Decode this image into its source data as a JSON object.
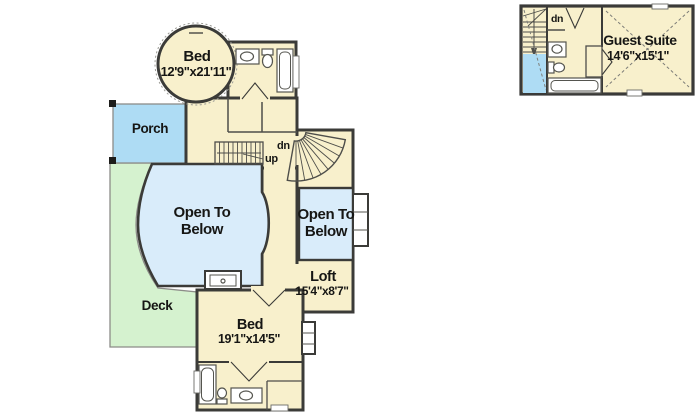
{
  "canvas": {
    "width": 700,
    "height": 412,
    "background": "#ffffff"
  },
  "colors": {
    "floor": "#f8f0cc",
    "wall": "#3b3b38",
    "open_below": "#d9ecfa",
    "porch": "#aedcf4",
    "deck": "#d5f2cf"
  },
  "main_plan": {
    "turret_bed": {
      "name": "Bed",
      "dims": "12'9\"x21'11\""
    },
    "porch": {
      "label": "Porch"
    },
    "deck": {
      "label": "Deck"
    },
    "open_below_left": {
      "line1": "Open To",
      "line2": "Below"
    },
    "open_below_right": {
      "line1": "Open To",
      "line2": "Below"
    },
    "loft": {
      "name": "Loft",
      "dims": "15'4\"x8'7\""
    },
    "lower_bed": {
      "name": "Bed",
      "dims": "19'1\"x14'5\""
    },
    "stair_up_label": "up",
    "stair_dn_label": "dn"
  },
  "guest_plan": {
    "suite": {
      "name": "Guest Suite",
      "dims": "14'6\"x15'1\""
    },
    "stair_dn_label": "dn"
  }
}
